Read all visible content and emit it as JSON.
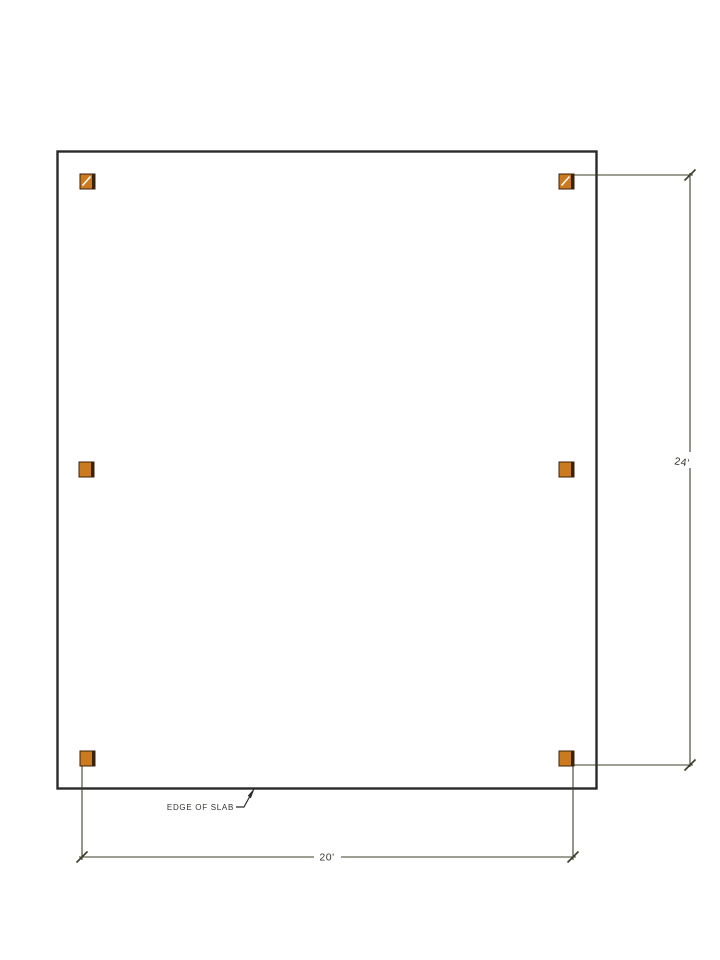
{
  "page": {
    "background": "#ffffff",
    "description": "CAD slab framing plan: rectangular slab outline with six square columns and two dimension strings"
  },
  "labels": {
    "edge_of_slab": "EDGE OF SLAB",
    "width_dimension": "20'",
    "height_dimension": "24'"
  },
  "dimensions": {
    "width_ft": 20,
    "height_ft": 24
  },
  "columns": {
    "count": 6,
    "rows": 3,
    "cols": 2,
    "marker": "filled-square",
    "size": 15,
    "positions": [
      {
        "x": 80,
        "y": 174,
        "hatched": true
      },
      {
        "x": 559,
        "y": 174,
        "hatched": true
      },
      {
        "x": 79,
        "y": 462,
        "hatched": false
      },
      {
        "x": 559,
        "y": 462,
        "hatched": false
      },
      {
        "x": 80,
        "y": 751,
        "hatched": false
      },
      {
        "x": 559,
        "y": 751,
        "hatched": false
      }
    ]
  },
  "colors": {
    "slab_outline": "#2a2a28",
    "column_fill": "#cc7a1e",
    "column_edge": "#38220a",
    "column_hatch": "#ffffff",
    "dimension_line": "#3e3e2b",
    "leader_line": "#2b2b2b",
    "label_text": "#3a392f",
    "background": "#ffffff"
  }
}
